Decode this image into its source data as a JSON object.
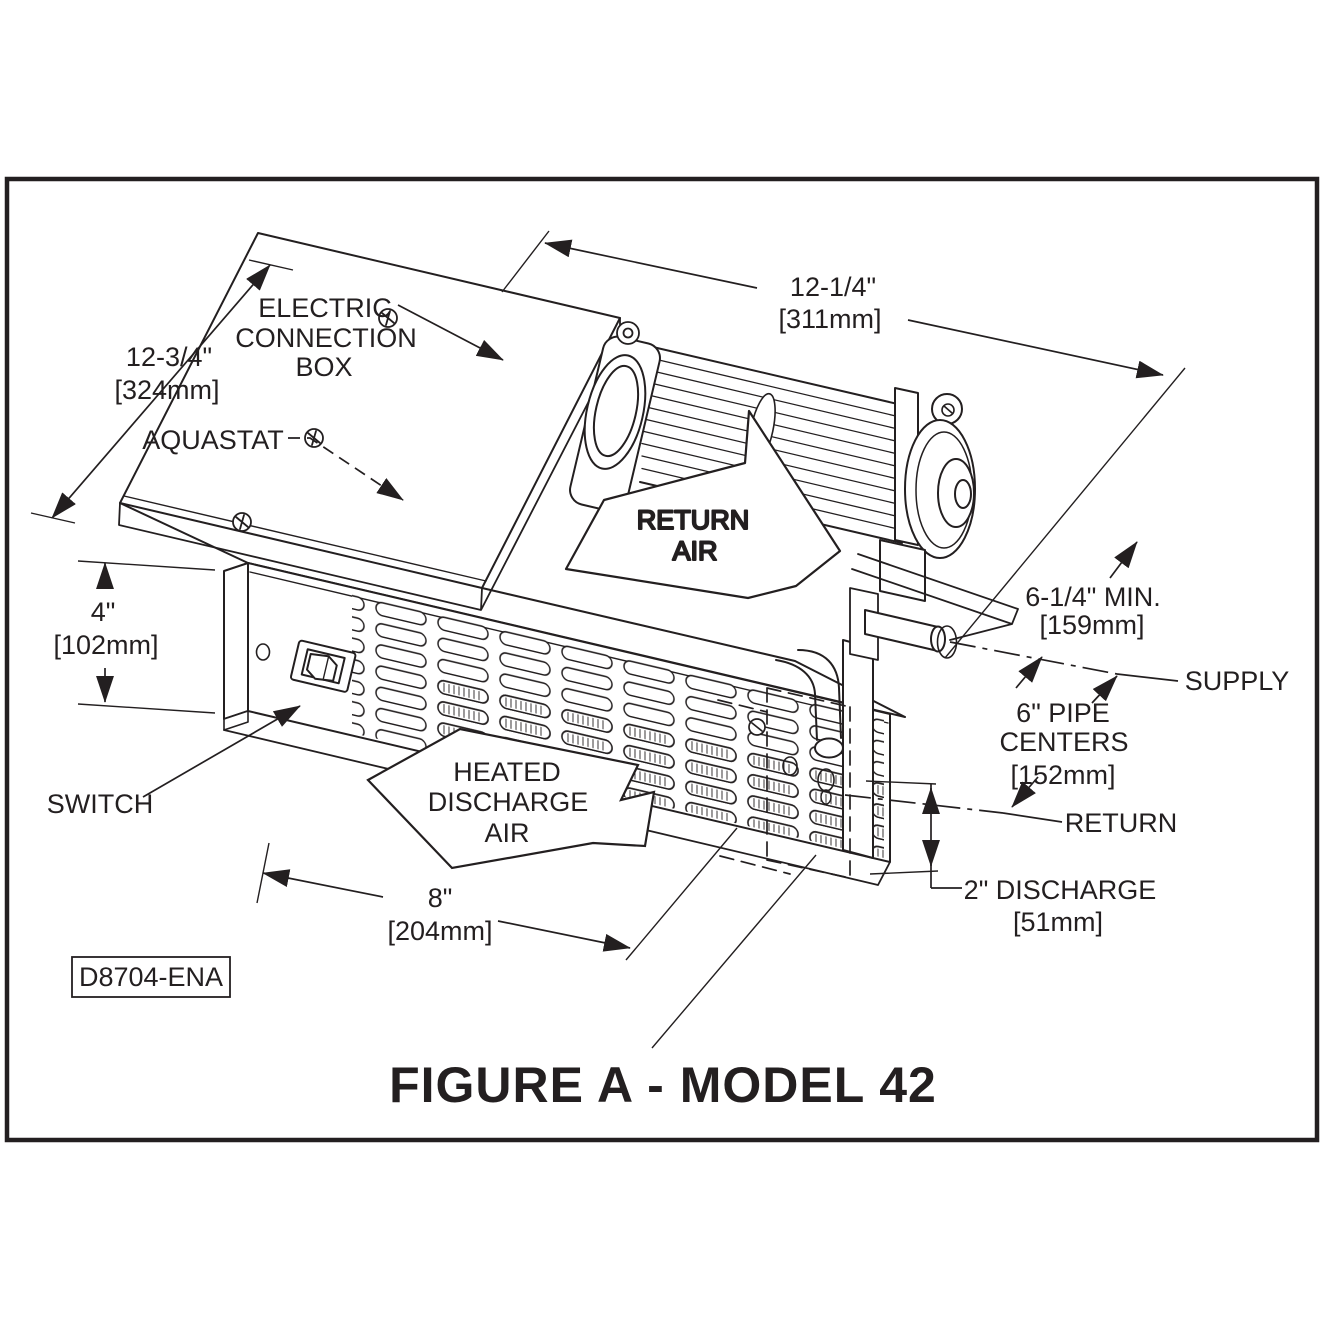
{
  "figure": {
    "title": "FIGURE A - MODEL 42",
    "drawing_number": "D8704-ENA",
    "type": "isometric-technical-drawing",
    "subject": "Model 42 kickspace heater with tangential blower"
  },
  "colors": {
    "ink": "#231f20",
    "background": "#ffffff"
  },
  "labels": {
    "electric_connection_box": [
      "ELECTRIC",
      "CONNECTION",
      "BOX"
    ],
    "aquastat": "AQUASTAT",
    "switch": "SWITCH",
    "return_air": [
      "RETURN",
      "AIR"
    ],
    "heated_discharge_air": [
      "HEATED",
      "DISCHARGE",
      "AIR"
    ],
    "supply": "SUPPLY",
    "return_pipe": "RETURN",
    "pipe_centers": [
      "6\" PIPE",
      "CENTERS",
      "[152mm]"
    ]
  },
  "dimensions": {
    "panel_height": {
      "in": "12-3/4\"",
      "mm": "[324mm]"
    },
    "blower_length": {
      "in": "12-1/4\"",
      "mm": "[311mm]"
    },
    "front_height": {
      "in": "4\"",
      "mm": "[102mm]"
    },
    "discharge_width": {
      "in": "8\"",
      "mm": "[204mm]"
    },
    "clearance": {
      "in": "6-1/4\" MIN.",
      "mm": "[159mm]"
    },
    "discharge_height": {
      "in": "2\" DISCHARGE",
      "mm": "[51mm]"
    }
  }
}
